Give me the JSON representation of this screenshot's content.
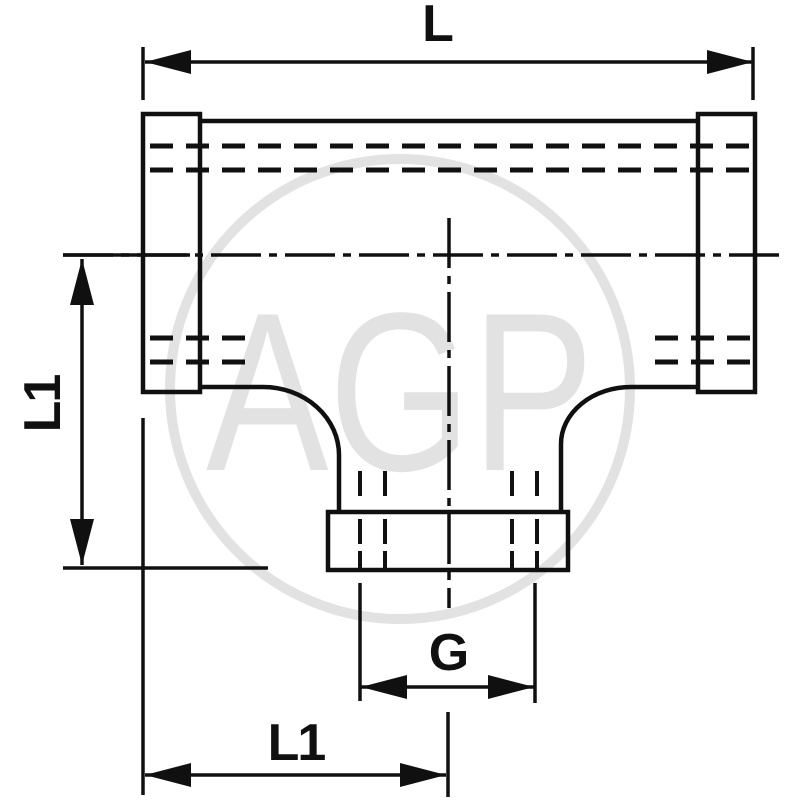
{
  "drawing": {
    "title": "Tee fitting dimensional drawing",
    "view": "front-section"
  },
  "labels": {
    "overall_length": "L",
    "height_left": "L1",
    "thread_size": "G",
    "length_bottom": "L1"
  },
  "watermark": {
    "text": "AGP"
  },
  "colors": {
    "line": "#101010",
    "watermark": "#e2e2e2",
    "background": "#ffffff"
  }
}
